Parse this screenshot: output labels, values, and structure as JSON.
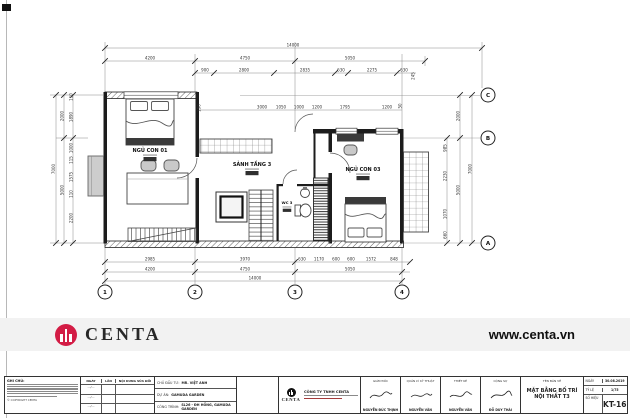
{
  "brand": {
    "word": "CENTA",
    "url": "www.centa.vn",
    "accent_color": "#d31c45"
  },
  "plan": {
    "rooms": [
      {
        "name": "NGỦ CON 01",
        "x": 150,
        "y": 152
      },
      {
        "name": "SẢNH TẦNG 3",
        "x": 252,
        "y": 166
      },
      {
        "name": "NGỦ CON 03",
        "x": 363,
        "y": 171
      },
      {
        "name": "WC 3",
        "x": 287,
        "y": 204,
        "small": true
      }
    ],
    "dim_labels": [
      {
        "t": "14000",
        "x": 293,
        "y": 46.5
      },
      {
        "t": "4200",
        "x": 150,
        "y": 59.5
      },
      {
        "t": "4750",
        "x": 245,
        "y": 59.5
      },
      {
        "t": "5050",
        "x": 350,
        "y": 59.5
      },
      {
        "t": "900",
        "x": 205,
        "y": 71.5
      },
      {
        "t": "2800",
        "x": 244,
        "y": 71.5
      },
      {
        "t": "2835",
        "x": 305,
        "y": 71.5
      },
      {
        "t": "630",
        "x": 341,
        "y": 71.5
      },
      {
        "t": "2275",
        "x": 372,
        "y": 71.5
      },
      {
        "t": "630",
        "x": 404,
        "y": 71.5
      },
      {
        "t": "245",
        "x": 414.5,
        "y": 76,
        "r": 1
      },
      {
        "t": "190",
        "x": 200.5,
        "y": 108,
        "r": 1
      },
      {
        "t": "3000",
        "x": 262,
        "y": 108.5
      },
      {
        "t": "1050",
        "x": 281,
        "y": 108.5
      },
      {
        "t": "1000",
        "x": 299,
        "y": 108.5
      },
      {
        "t": "1200",
        "x": 317,
        "y": 108.5
      },
      {
        "t": "1795",
        "x": 345,
        "y": 108.5
      },
      {
        "t": "1200",
        "x": 387,
        "y": 108.5
      },
      {
        "t": "50",
        "x": 401.5,
        "y": 106,
        "r": 1
      },
      {
        "t": "2985",
        "x": 150,
        "y": 260.5
      },
      {
        "t": "3970",
        "x": 245,
        "y": 260.5
      },
      {
        "t": "630",
        "x": 302,
        "y": 260.5
      },
      {
        "t": "1170",
        "x": 319,
        "y": 260.5
      },
      {
        "t": "600",
        "x": 336,
        "y": 260.5
      },
      {
        "t": "600",
        "x": 351,
        "y": 260.5
      },
      {
        "t": "1572",
        "x": 371,
        "y": 260.5
      },
      {
        "t": "848",
        "x": 394,
        "y": 260.5
      },
      {
        "t": "4200",
        "x": 150,
        "y": 270.5
      },
      {
        "t": "4750",
        "x": 245,
        "y": 270.5
      },
      {
        "t": "5050",
        "x": 350,
        "y": 270.5
      },
      {
        "t": "14000",
        "x": 255,
        "y": 279.5
      },
      {
        "t": "7000",
        "x": 55,
        "y": 169,
        "r": 1
      },
      {
        "t": "2000",
        "x": 63.5,
        "y": 116,
        "r": 1
      },
      {
        "t": "5000",
        "x": 63.5,
        "y": 190,
        "r": 1
      },
      {
        "t": "110",
        "x": 72.5,
        "y": 97,
        "r": 1
      },
      {
        "t": "1890",
        "x": 72.5,
        "y": 117,
        "r": 1
      },
      {
        "t": "1000",
        "x": 72.5,
        "y": 148,
        "r": 1
      },
      {
        "t": "115",
        "x": 72.5,
        "y": 160,
        "r": 1
      },
      {
        "t": "1575",
        "x": 72.5,
        "y": 177,
        "r": 1
      },
      {
        "t": "110",
        "x": 72.5,
        "y": 194,
        "r": 1
      },
      {
        "t": "2200",
        "x": 72.5,
        "y": 218,
        "r": 1
      },
      {
        "t": "2000",
        "x": 459.5,
        "y": 116,
        "r": 1
      },
      {
        "t": "5000",
        "x": 459.5,
        "y": 190,
        "r": 1
      },
      {
        "t": "7000",
        "x": 471.5,
        "y": 169,
        "r": 1
      },
      {
        "t": "985",
        "x": 446.5,
        "y": 148,
        "r": 1
      },
      {
        "t": "2230",
        "x": 446.5,
        "y": 176,
        "r": 1
      },
      {
        "t": "1070",
        "x": 446.5,
        "y": 214,
        "r": 1
      },
      {
        "t": "660",
        "x": 446.5,
        "y": 235,
        "r": 1
      }
    ],
    "grid_bubbles": [
      {
        "t": "1",
        "x": 105,
        "y": 292
      },
      {
        "t": "2",
        "x": 195,
        "y": 292
      },
      {
        "t": "3",
        "x": 295,
        "y": 292
      },
      {
        "t": "4",
        "x": 402,
        "y": 292
      },
      {
        "t": "C",
        "x": 488,
        "y": 95
      },
      {
        "t": "B",
        "x": 488,
        "y": 138
      },
      {
        "t": "A",
        "x": 488,
        "y": 243
      }
    ]
  },
  "footer": {
    "notes": {
      "title": "GHI CHÚ:",
      "copyright": "© COPYRIGHT CENTA"
    },
    "revisions": {
      "headers": [
        "NGÀY",
        "LẦN",
        "NỘI DUNG SỬA ĐỔI"
      ],
      "rows": [
        {
          "date": "…/…",
          "no": "",
          "content": ""
        },
        {
          "date": "…/…",
          "no": "",
          "content": ""
        },
        {
          "date": "…/…",
          "no": "",
          "content": ""
        }
      ]
    },
    "project": {
      "client_label": "CHỦ ĐẦU TƯ:",
      "client": "MR. VIỆT ANH",
      "project_label": "DỰ ÁN:",
      "project": "GAMUDA GARDEN",
      "work_label": "CÔNG TRÌNH:",
      "work": "SL26 - ĐH HỒNG, GAMUDA GARDEN"
    },
    "company": {
      "name": "CÔNG TY TNHH CENTA",
      "brand": "CENTA"
    },
    "signers": [
      {
        "role": "GIÁM ĐỐC",
        "name": "NGUYỄN ĐỨC THỊNH"
      },
      {
        "role": "QUẢN LÝ KỸ THUẬT",
        "name": "NGUYỄN VĂN"
      },
      {
        "role": "THIẾT KẾ",
        "name": "NGUYỄN VĂN"
      },
      {
        "role": "CỘNG SỰ",
        "name": "ĐỖ DUY THÁI"
      }
    ],
    "drawing": {
      "title_label": "TÊN BẢN VẼ",
      "title": "MẶT BẰNG BỐ TRÍ NỘI THẤT T3"
    },
    "meta": {
      "date_label": "NGÀY",
      "date": "30.08.2019",
      "scale_label": "TỶ LỆ",
      "scale": "1/75",
      "code_label": "SỐ HIỆU",
      "code": "KT-16"
    }
  }
}
